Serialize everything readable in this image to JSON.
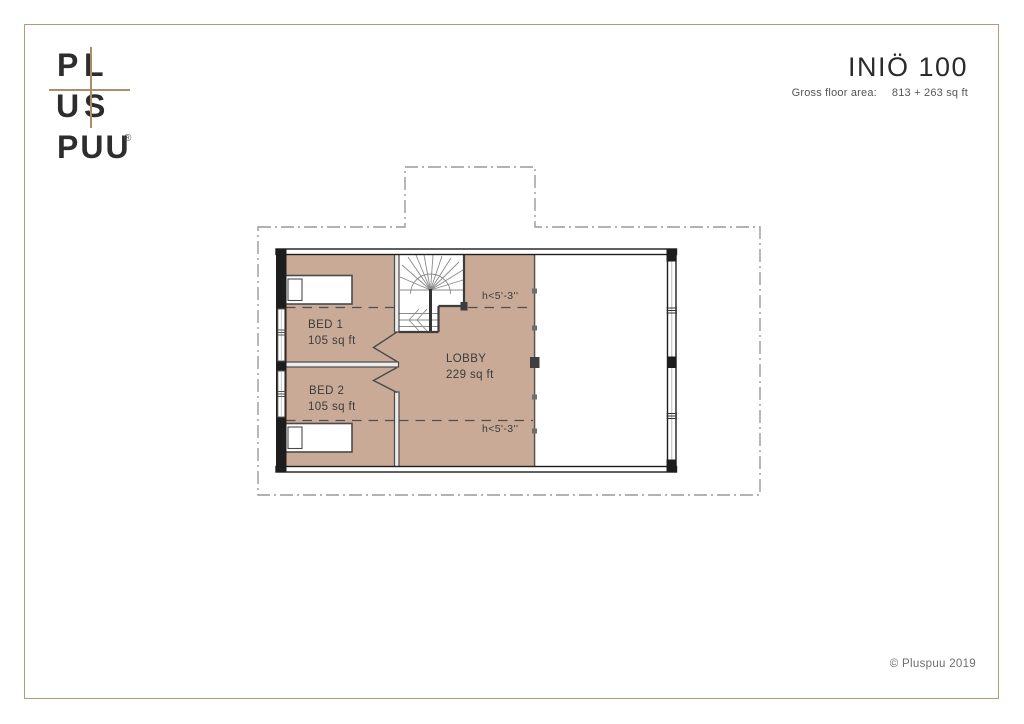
{
  "logo": {
    "p": "P",
    "l": "L",
    "u": "U",
    "s": "S",
    "word": "PUU",
    "registered": "®",
    "cross_color": "#ac8e6a",
    "letter_color": "#2d2d2d"
  },
  "header": {
    "title": "INIÖ 100",
    "gross_label": "Gross floor area:",
    "gross_value": "813 + 263 sq ft"
  },
  "floor_plan": {
    "rooms": [
      {
        "name": "BED 1",
        "area": "105 sq ft"
      },
      {
        "name": "BED 2",
        "area": "105 sq ft"
      },
      {
        "name": "LOBBY",
        "area": "229 sq ft"
      }
    ],
    "height_notes": [
      {
        "text": "h<5'-3''"
      },
      {
        "text": "h<5'-3''"
      }
    ],
    "room_fill_color": "#c8aa97",
    "wall_color": "#1d1d1d",
    "roof_outline_color": "#999999"
  },
  "page": {
    "border_color": "#b49a7e"
  },
  "footer": {
    "copyright": "© Pluspuu 2019"
  }
}
